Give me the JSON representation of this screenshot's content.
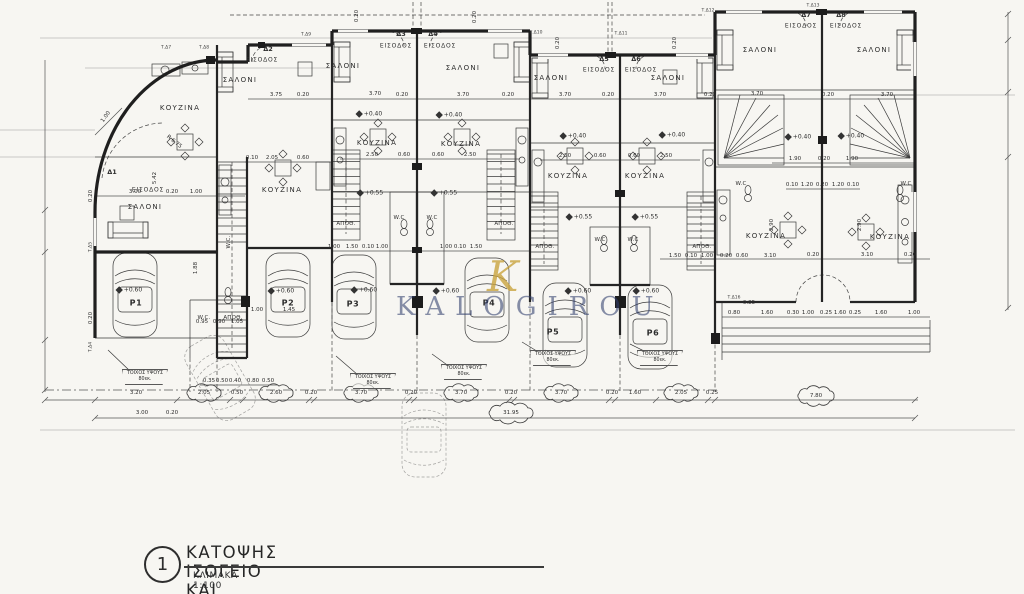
{
  "sheet": {
    "number": "1",
    "title": "ΚΑΤΟΨΗΣ ΙΣΟΓΕΙΟ ΚΑΙ ΥΠΟΣΤΕΓΟΥ",
    "scale": "ΚΛΙΜΑΚΑ 1:100"
  },
  "watermark": {
    "monogram": "K",
    "name": "KALOGIROU",
    "gold": "#c9a43f",
    "navy": "#33406f"
  },
  "rooms": {
    "living": "ΣΑΛΟΝΙ",
    "kitchen": "ΚΟΥΖΙΝΑ",
    "entrance": "ΕΙΣΟΔΟΣ",
    "wc": "W.C.",
    "wc_short": "W.C",
    "storage": "ΑΠΟΘ."
  },
  "notes": {
    "low_wall_1": "ΤΟΙΧΟΣ ΥΨΟΥΣ",
    "low_wall_2": "80εκ."
  },
  "levels": {
    "plus040": "+0.40",
    "plus055": "+0.55",
    "plus060": "+0.60"
  },
  "units": {
    "d1": "Δ1",
    "d2": "Δ2",
    "d3": "Δ3",
    "d4": "Δ4",
    "d5": "Δ5",
    "d6": "Δ6",
    "d7": "Δ7",
    "d8": "Δ8"
  },
  "tags": {
    "t4": "Τ.Δ4",
    "t5": "Τ.Δ5",
    "t7": "Τ.Δ7",
    "t8": "Τ.Δ8",
    "t9": "Τ.Δ9",
    "t10": "Τ.Δ10",
    "t11": "Τ.Δ11",
    "t12": "Τ.Δ12",
    "t13": "Τ.Δ13",
    "t16": "Τ.Δ16"
  },
  "parking": {
    "p1": "P1",
    "p2": "P2",
    "p3": "P3",
    "p4": "P4",
    "p5": "P5",
    "p6": "P6"
  },
  "dimensions": {
    "bottom_chain": [
      "3.20",
      "2.05",
      "0.50",
      "2.60",
      "0.20",
      "3.70",
      "0.20",
      "3.70",
      "0.20",
      "3.70",
      "0.20",
      "1.60",
      "2.05",
      "0.25",
      "7.80"
    ],
    "overall_width": "31.95",
    "front_offsets": [
      "0.35",
      "0.50",
      "0.40",
      "0.80",
      "0.50"
    ],
    "values": {
      "v010": "0.10",
      "v020": "0.20",
      "v025": "0.25",
      "v030": "0.30",
      "v040": "0.40",
      "v050": "0.50",
      "v060": "0.60",
      "v070": "0.70",
      "v080": "0.80",
      "v085": "0.85",
      "v090": "0.90",
      "v095": "0.95",
      "v100": "1.00",
      "v105": "1.05",
      "v120": "1.20",
      "v145": "1.45",
      "v150": "1.50",
      "v160": "1.60",
      "v188": "1.88",
      "v190": "1.90",
      "v205": "2.05",
      "v250": "2.50",
      "v260": "2.60",
      "v290": "2.90",
      "v300": "3.00",
      "v310": "3.10",
      "v320": "3.20",
      "v370": "3.70",
      "v375": "3.75",
      "v542": "5.42",
      "v780": "7.80",
      "r675": "R 6.75"
    }
  }
}
